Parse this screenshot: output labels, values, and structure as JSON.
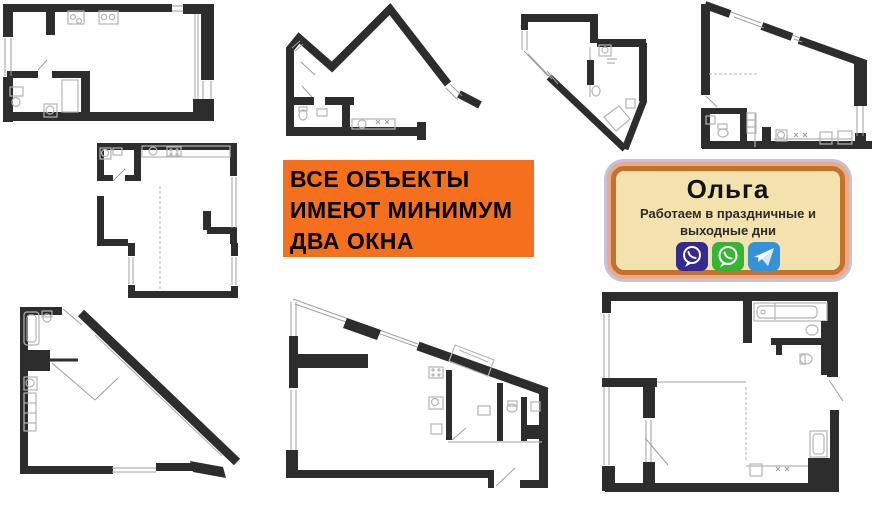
{
  "banner": {
    "lines": [
      "ВСЕ ОБЪЕКТЫ",
      "ИМЕЮТ МИНИМУМ",
      "ДВА ОКНА"
    ],
    "background_color": "#f5701d",
    "text_color": "#000000"
  },
  "contact_card": {
    "name": "Ольга",
    "subtitle_lines": [
      "Работаем в праздничные и",
      "выходные дни"
    ],
    "background_color": "#f3e2ae",
    "border_color": "#c2722e",
    "ring_colors": [
      "#edaa85",
      "#c2c2e0"
    ],
    "messengers": [
      {
        "name": "viber",
        "color": "#33298f"
      },
      {
        "name": "whatsapp",
        "color": "#35b435"
      },
      {
        "name": "telegram",
        "color": "#3492d8"
      }
    ]
  },
  "floorplans": {
    "wall_color": "#2d2d2d",
    "fixture_color": "#b5b5b5",
    "count": 8,
    "items": [
      {
        "id": "floorplan-top-left",
        "shape": "rectangular studio"
      },
      {
        "id": "floorplan-top-middle",
        "shape": "double-peak polygon"
      },
      {
        "id": "floorplan-top-center-right",
        "shape": "pentagon with diagonal cut"
      },
      {
        "id": "floorplan-top-right",
        "shape": "sloped-roof trapezoid"
      },
      {
        "id": "floorplan-middle-left",
        "shape": "stepped L-shape"
      },
      {
        "id": "floorplan-bottom-left",
        "shape": "right triangle"
      },
      {
        "id": "floorplan-bottom-middle",
        "shape": "sloped trapezoid"
      },
      {
        "id": "floorplan-bottom-right",
        "shape": "rectangle with bathroom"
      }
    ]
  }
}
